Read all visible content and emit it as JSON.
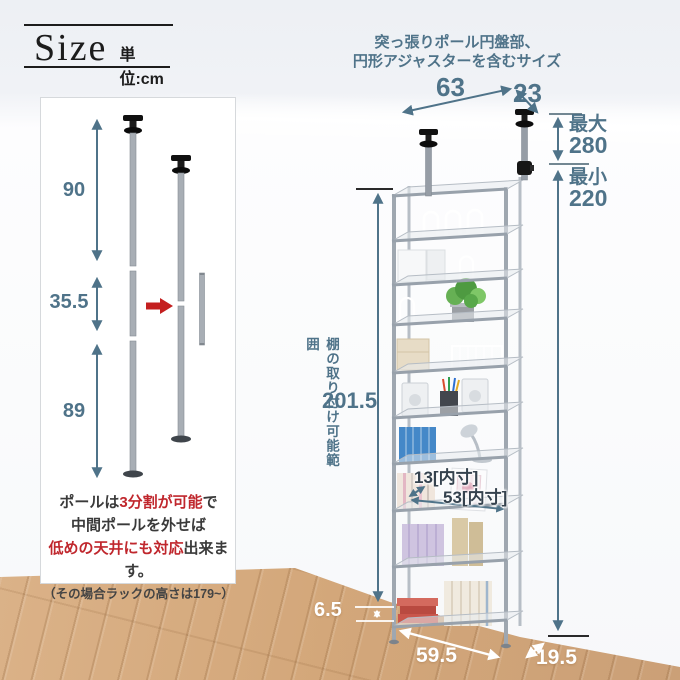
{
  "colors": {
    "dimension_blue": "#4f7389",
    "red_accent": "#c0272d",
    "floor_wood": "#d5ab80",
    "text_dark": "#3a3a3a"
  },
  "header": {
    "title": "Size",
    "unit": "単位:cm"
  },
  "top_note": {
    "line1": "突っ張りポール円盤部、",
    "line2": "円形アジャスターを含むサイズ"
  },
  "dims": {
    "top_width": "63",
    "top_depth": "23",
    "max_label": "最大",
    "max_value": "280",
    "min_label": "最小",
    "min_value": "220",
    "range_label": "棚の取り付け可能範囲",
    "range_value": "201.5",
    "inner_height": "13[内寸]",
    "inner_width": "53[内寸]",
    "bottom_gap": "6.5",
    "base_width": "59.5",
    "base_depth": "19.5"
  },
  "pole_panel": {
    "seg_top": "90",
    "seg_mid": "35.5",
    "seg_bottom": "89",
    "note": {
      "l1a": "ポールは",
      "l1b": "3分割が可能",
      "l1c": "で",
      "l2": "中間ポールを外せば",
      "l3a": "低めの天井にも対応",
      "l3b": "出来ます。",
      "l4": "（その場合ラックの高さは179~）"
    }
  }
}
